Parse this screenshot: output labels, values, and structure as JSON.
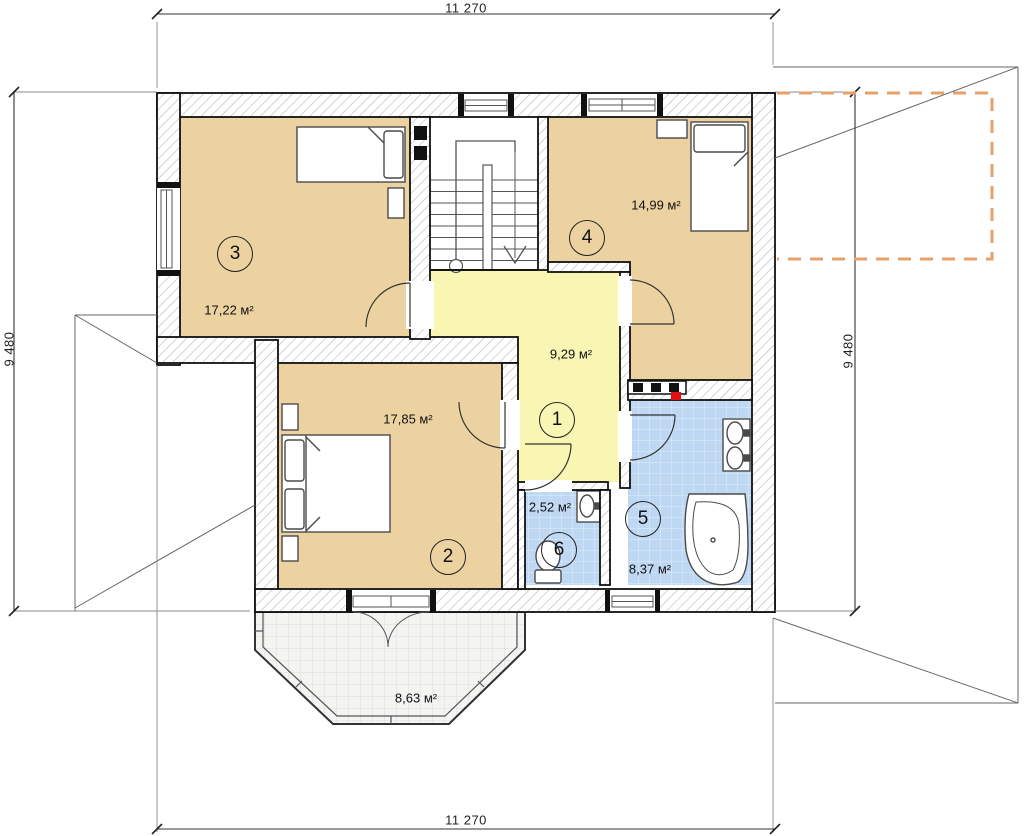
{
  "plan": {
    "dimensions": {
      "top": "11 270",
      "bottom": "11 270",
      "left": "9 480",
      "right": "9 480"
    },
    "rooms": [
      {
        "number": "1",
        "area": "9,29 м²"
      },
      {
        "number": "2",
        "area": "17,85 м²"
      },
      {
        "number": "3",
        "area": "17,22 м²"
      },
      {
        "number": "4",
        "area": "14,99 м²"
      },
      {
        "number": "5",
        "area": "8,37 м²"
      },
      {
        "number": "6",
        "area": "2,52 м²"
      },
      {
        "number": "",
        "area": "8,63 м²"
      }
    ],
    "colors": {
      "room_fill": "#EDD2A1",
      "hall_fill": "#F8F6B2",
      "wet_room_fill": "#BED7F2",
      "balcony_fill": "#F4F4F3",
      "roof_overlay_dash": "#E5A169",
      "flue_marker_red": "#E01010"
    }
  }
}
